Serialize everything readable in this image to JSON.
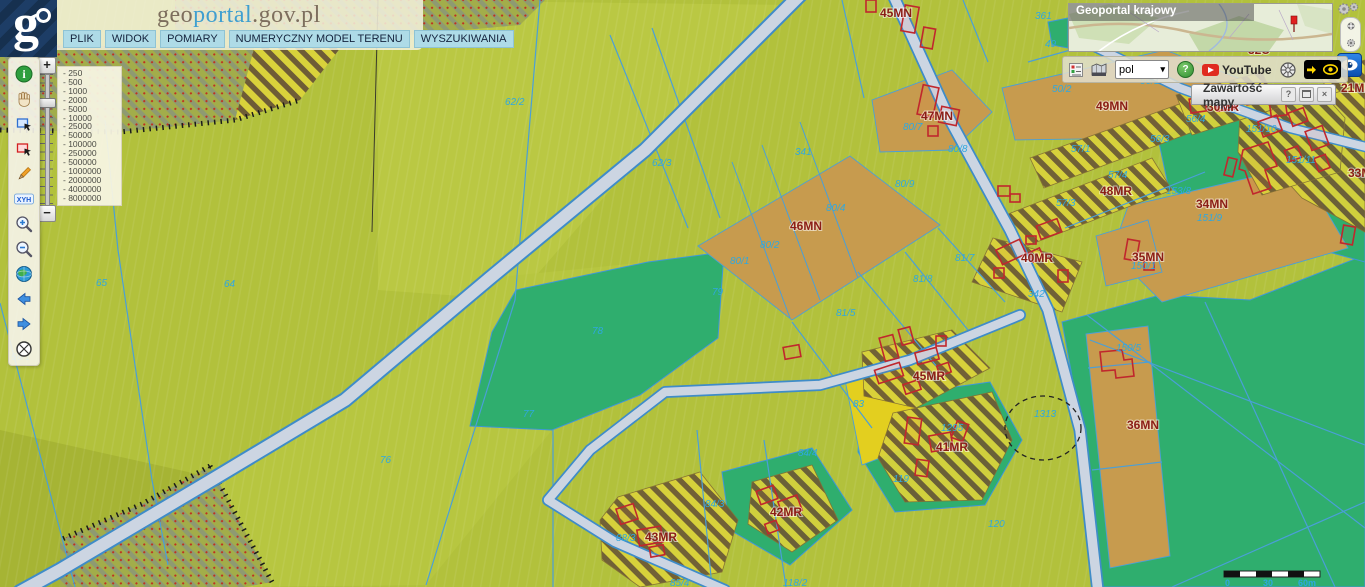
{
  "header": {
    "title_part1": "geo",
    "title_part2": "portal",
    "title_part3": ".gov.pl"
  },
  "menu": {
    "items": [
      "PLIK",
      "WIDOK",
      "POMIARY",
      "NUMERYCZNY MODEL TERENU",
      "WYSZUKIWANIA"
    ]
  },
  "left_toolbar": {
    "tools": [
      "info",
      "pan",
      "select-area-blue",
      "select-area-red",
      "draw",
      "xyh-coordinates",
      "zoom-in",
      "zoom-out",
      "globe",
      "history-back",
      "history-forward",
      "full-extent"
    ],
    "xyh_label": "XYH"
  },
  "slider": {
    "plus_label": "+",
    "minus_label": "−"
  },
  "scale_panel": {
    "values": [
      "- 250",
      "- 500",
      "- 1000",
      "- 2000",
      "- 5000",
      "- 10000",
      "- 25000",
      "- 50000",
      "- 100000",
      "- 250000",
      "- 500000",
      "- 1000000",
      "- 2000000",
      "- 4000000",
      "- 8000000"
    ]
  },
  "overview": {
    "title": "Geoportal krajowy"
  },
  "toolbar": {
    "language_value": "pol",
    "help_label": "?",
    "youtube_label": "YouTube"
  },
  "map_content_panel": {
    "title": "Zawartość mapy",
    "help_label": "?",
    "close_label": "×"
  },
  "colors": {
    "field_olive": "#b2c13c",
    "zone_teal": "#2fae6e",
    "zone_tan": "#c79b4e",
    "zone_yellow": "#e3cf1f",
    "stripe_dark": "#6e5c36",
    "stripe_light": "#d9d23b",
    "road_fill": "#ccd5e2",
    "road_edge": "#3f8cc8",
    "parcel_line": "#4a9fd8",
    "zone_label": "#8b1d15",
    "parcel_label": "#2fa8e0",
    "building": "#c0272d"
  },
  "map": {
    "zone_labels": [
      {
        "text": "45MN",
        "x": 880,
        "y": 17
      },
      {
        "text": "47MN",
        "x": 921,
        "y": 120
      },
      {
        "text": "49MN",
        "x": 1096,
        "y": 110
      },
      {
        "text": "30MR",
        "x": 1207,
        "y": 111
      },
      {
        "text": "21MR",
        "x": 1341,
        "y": 92
      },
      {
        "text": "32U",
        "x": 1248,
        "y": 54
      },
      {
        "text": "48MR",
        "x": 1100,
        "y": 195
      },
      {
        "text": "33MR",
        "x": 1348,
        "y": 177
      },
      {
        "text": "34MN",
        "x": 1196,
        "y": 208
      },
      {
        "text": "46MN",
        "x": 790,
        "y": 230
      },
      {
        "text": "35MN",
        "x": 1132,
        "y": 261
      },
      {
        "text": "40MR",
        "x": 1021,
        "y": 262
      },
      {
        "text": "36MN",
        "x": 1127,
        "y": 429
      },
      {
        "text": "45MR",
        "x": 913,
        "y": 380
      },
      {
        "text": "41MR",
        "x": 936,
        "y": 451
      },
      {
        "text": "42MR",
        "x": 770,
        "y": 516
      },
      {
        "text": "43MR",
        "x": 645,
        "y": 541
      }
    ],
    "parcel_labels": [
      {
        "text": "62/2",
        "x": 505,
        "y": 105
      },
      {
        "text": "62/3",
        "x": 652,
        "y": 166
      },
      {
        "text": "64",
        "x": 224,
        "y": 287
      },
      {
        "text": "65",
        "x": 96,
        "y": 286
      },
      {
        "text": "66/1",
        "x": 11,
        "y": 360
      },
      {
        "text": "76",
        "x": 380,
        "y": 463
      },
      {
        "text": "77",
        "x": 523,
        "y": 417
      },
      {
        "text": "78",
        "x": 592,
        "y": 334
      },
      {
        "text": "79",
        "x": 712,
        "y": 295
      },
      {
        "text": "341",
        "x": 795,
        "y": 155
      },
      {
        "text": "361",
        "x": 1035,
        "y": 19
      },
      {
        "text": "49",
        "x": 1045,
        "y": 47
      },
      {
        "text": "50/2",
        "x": 1052,
        "y": 92
      },
      {
        "text": "56/1",
        "x": 1140,
        "y": 84
      },
      {
        "text": "56/4",
        "x": 1186,
        "y": 122
      },
      {
        "text": "56/3",
        "x": 1150,
        "y": 142
      },
      {
        "text": "57/1",
        "x": 1071,
        "y": 152
      },
      {
        "text": "57/4",
        "x": 1108,
        "y": 178
      },
      {
        "text": "57/3",
        "x": 1056,
        "y": 206
      },
      {
        "text": "80/7",
        "x": 903,
        "y": 130
      },
      {
        "text": "80/8",
        "x": 948,
        "y": 152
      },
      {
        "text": "80/9",
        "x": 895,
        "y": 187
      },
      {
        "text": "80/4",
        "x": 826,
        "y": 211
      },
      {
        "text": "80/2",
        "x": 760,
        "y": 248
      },
      {
        "text": "80/1",
        "x": 730,
        "y": 264
      },
      {
        "text": "81/7",
        "x": 955,
        "y": 261
      },
      {
        "text": "81/8",
        "x": 913,
        "y": 282
      },
      {
        "text": "81/5",
        "x": 836,
        "y": 316
      },
      {
        "text": "342",
        "x": 1028,
        "y": 297
      },
      {
        "text": "151/10",
        "x": 1246,
        "y": 132
      },
      {
        "text": "151/11",
        "x": 1286,
        "y": 163
      },
      {
        "text": "151/9",
        "x": 1197,
        "y": 221
      },
      {
        "text": "153/8",
        "x": 1166,
        "y": 194
      },
      {
        "text": "150/1",
        "x": 1131,
        "y": 269
      },
      {
        "text": "150/5",
        "x": 1116,
        "y": 351
      },
      {
        "text": "1313",
        "x": 1034,
        "y": 417
      },
      {
        "text": "83",
        "x": 853,
        "y": 407
      },
      {
        "text": "84/4",
        "x": 798,
        "y": 456
      },
      {
        "text": "84/3",
        "x": 705,
        "y": 507
      },
      {
        "text": "88/3",
        "x": 616,
        "y": 541
      },
      {
        "text": "85/4",
        "x": 670,
        "y": 586
      },
      {
        "text": "118/2",
        "x": 783,
        "y": 586
      },
      {
        "text": "119",
        "x": 893,
        "y": 482
      },
      {
        "text": "120",
        "x": 988,
        "y": 527
      },
      {
        "text": "1295",
        "x": 941,
        "y": 431
      }
    ],
    "scale_bar": {
      "labels": [
        {
          "text": "0",
          "x": 1225,
          "y": 586
        },
        {
          "text": "30",
          "x": 1263,
          "y": 586
        },
        {
          "text": "60m",
          "x": 1298,
          "y": 586
        }
      ]
    }
  }
}
